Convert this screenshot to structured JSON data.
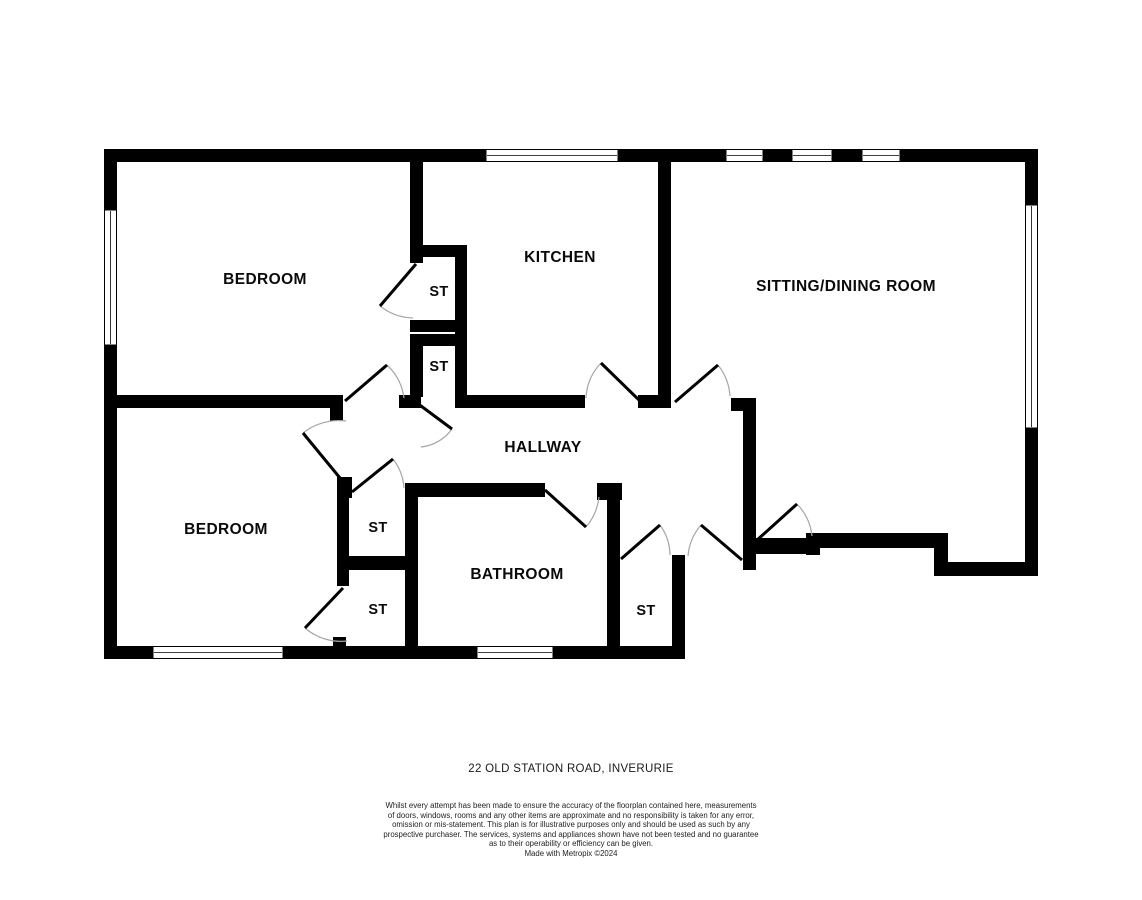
{
  "floorplan": {
    "room_labels": {
      "bedroom_top": "BEDROOM",
      "kitchen": "KITCHEN",
      "sitting_dining": "SITTING/DINING ROOM",
      "hallway": "HALLWAY",
      "bedroom_bottom": "BEDROOM",
      "bathroom": "BATHROOM",
      "storage": "ST"
    },
    "colors": {
      "wall": "#000000",
      "door_arc": "#a6a6a6",
      "background": "#ffffff"
    }
  },
  "footer": {
    "address": "22 OLD STATION ROAD, INVERURIE",
    "disclaimer_lines": [
      "Whilst every attempt has been made to ensure the accuracy of the floorplan contained here, measurements",
      "of doors, windows, rooms and any other items are approximate and no responsibility is taken for any error,",
      "omission or mis-statement. This plan is for illustrative purposes only and should be used as such by any",
      "prospective purchaser. The services, systems and appliances shown have not been tested and no guarantee",
      "as to their operability or efficiency can be given."
    ],
    "credit": "Made with Metropix ©2024"
  }
}
